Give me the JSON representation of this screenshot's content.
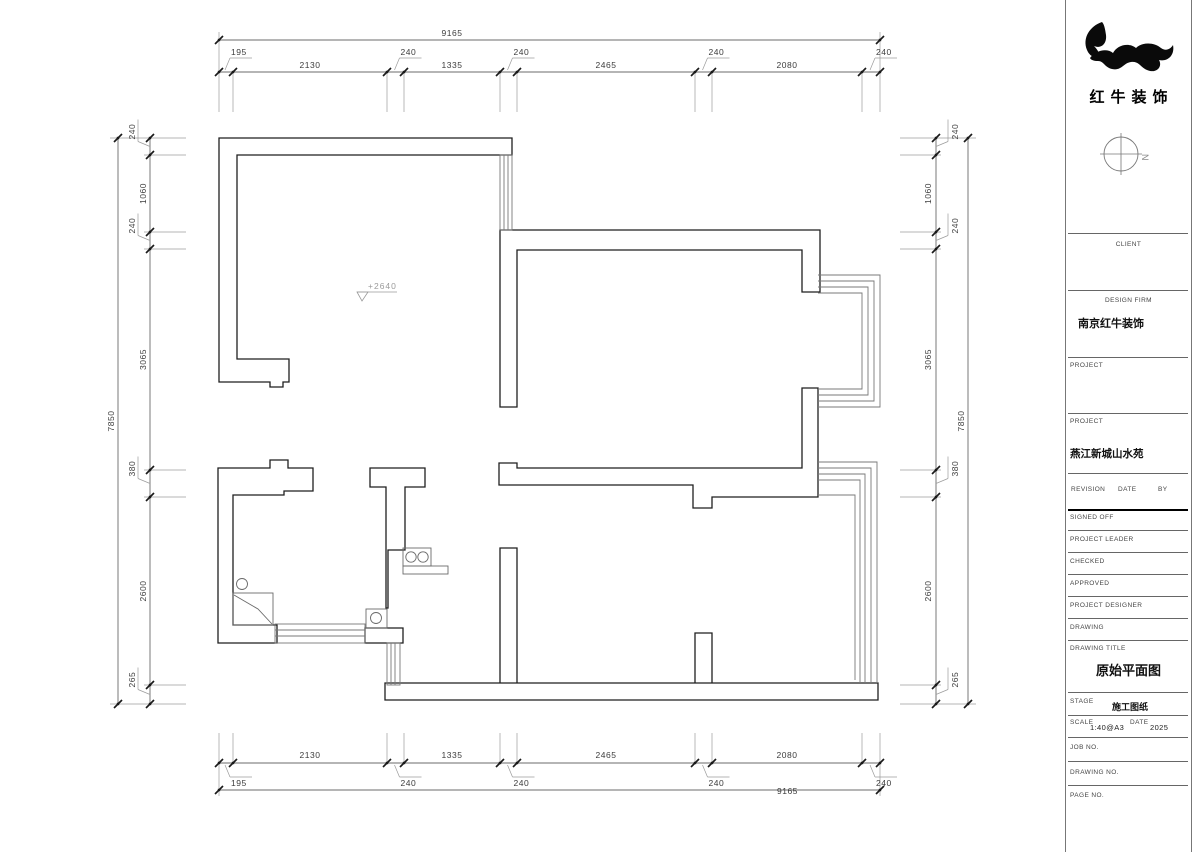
{
  "brand": {
    "name_cn": "红牛装饰"
  },
  "plan": {
    "level_marker": "+2640",
    "north_label": "N"
  },
  "dimensions": {
    "top": {
      "overall": "9165",
      "segments": [
        "195",
        "2130",
        "240",
        "1335",
        "240",
        "2465",
        "240",
        "2080",
        "240"
      ]
    },
    "bottom": {
      "overall": "9165",
      "segments": [
        "195",
        "2130",
        "240",
        "1335",
        "240",
        "2465",
        "240",
        "2080",
        "240"
      ]
    },
    "left": {
      "overall": "7850",
      "segments": [
        "240",
        "1060",
        "240",
        "3065",
        "380",
        "2600",
        "265"
      ]
    },
    "right": {
      "overall": "7850",
      "segments": [
        "240",
        "1060",
        "240",
        "3065",
        "380",
        "2600",
        "265"
      ]
    }
  },
  "title_block": {
    "client_label": "CLIENT",
    "design_firm_label": "DESIGN FIRM",
    "design_firm_value": "南京红牛装饰",
    "project_label_1": "PROJECT",
    "project_label_2": "PROJECT",
    "project_value": "燕江新城山水苑",
    "revision_label": "REVISION",
    "date_label": "DATE",
    "by_label": "BY",
    "signed_off_label": "SIGNED OFF",
    "project_leader_label": "PROJECT LEADER",
    "checked_label": "CHECKED",
    "approved_label": "APPROVED",
    "project_designer_label": "PROJECT DESIGNER",
    "drawing_label": "DRAWING",
    "drawing_title_label": "DRAWING TITLE",
    "drawing_title_value": "原始平面图",
    "stage_label": "STAGE",
    "stage_value": "施工图纸",
    "scale_label": "SCALE",
    "scale_value": "1:40@A3",
    "date2_label": "DATE",
    "date_value": "2025",
    "job_no_label": "JOB NO.",
    "drawing_no_label": "DRAWING NO.",
    "page_no_label": "PAGE NO."
  }
}
